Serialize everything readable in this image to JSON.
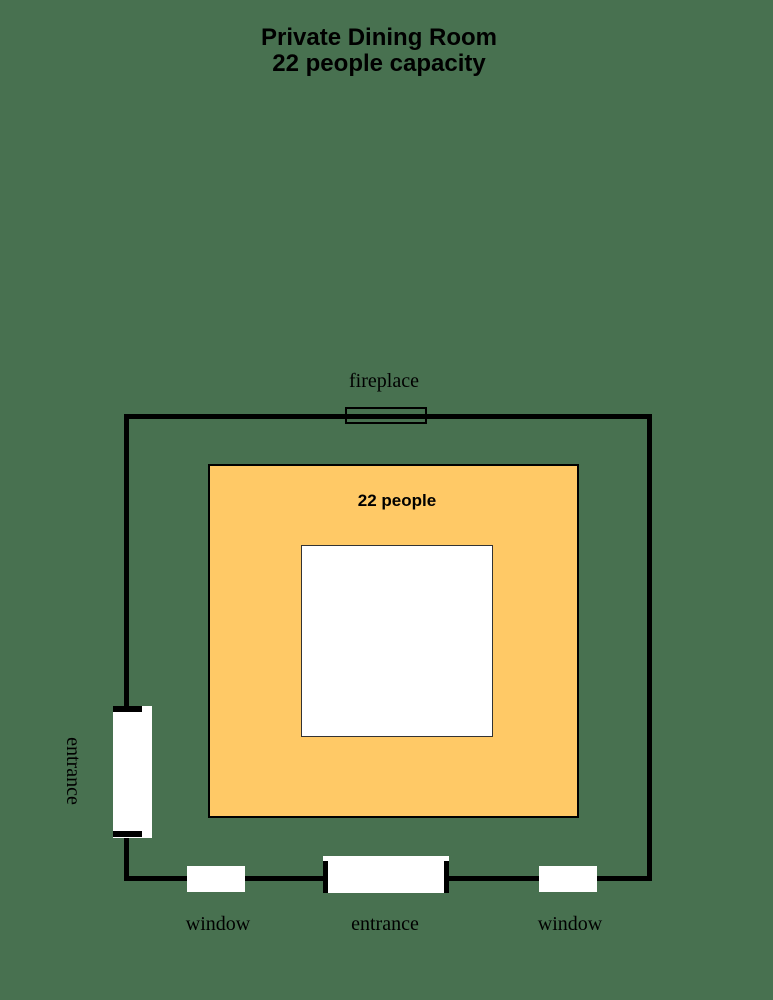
{
  "title": {
    "line1": "Private Dining Room",
    "line2": "22 people capacity"
  },
  "floor_plan": {
    "capacity_label": "22 people",
    "fireplace_label": "fireplace",
    "left_entrance_label": "entrance",
    "bottom_entrance_label": "entrance",
    "left_window_label": "window",
    "right_window_label": "window"
  },
  "colors": {
    "background": "#487150",
    "wall": "#000000",
    "table_fill": "#FFC966",
    "opening_fill": "#FFFFFF"
  }
}
